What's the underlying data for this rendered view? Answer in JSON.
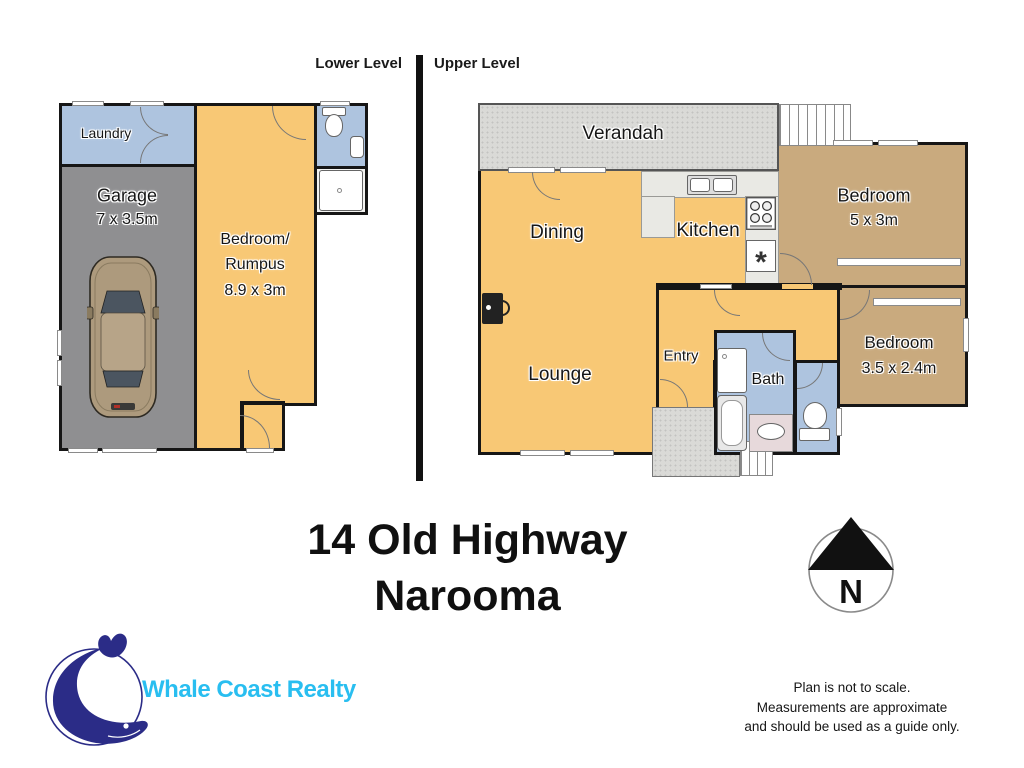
{
  "header": {
    "lower_label": "Lower Level",
    "upper_label": "Upper Level"
  },
  "title": {
    "line1": "14 Old Highway",
    "line2": "Narooma"
  },
  "compass": {
    "letter": "N"
  },
  "logo": {
    "name": "Whale Coast Realty"
  },
  "disclaimer": {
    "line1": "Plan is not to scale.",
    "line2": "Measurements are approximate",
    "line3": "and should be used as a guide only."
  },
  "lower_level": {
    "laundry": {
      "label": "Laundry"
    },
    "garage": {
      "label": "Garage",
      "size": "7 x 3.5m"
    },
    "bedroom_rumpus": {
      "line1": "Bedroom/",
      "line2": "Rumpus",
      "size": "8.9 x 3m"
    }
  },
  "upper_level": {
    "verandah": {
      "label": "Verandah"
    },
    "dining": {
      "label": "Dining"
    },
    "kitchen": {
      "label": "Kitchen",
      "appliance_symbol": "*"
    },
    "bedroom_large": {
      "label": "Bedroom",
      "size": "5 x 3m"
    },
    "lounge": {
      "label": "Lounge"
    },
    "entry": {
      "label": "Entry"
    },
    "bath": {
      "label": "Bath"
    },
    "bedroom_small": {
      "label": "Bedroom",
      "size": "3.5 x 2.4m"
    }
  },
  "colors": {
    "room_orange": "#F8C875",
    "room_blue": "#AEC4DF",
    "room_tan": "#C9AA7E",
    "garage_gray": "#8F8F91",
    "deck_gray": "#DADAD7",
    "wall_black": "#161616",
    "logo_cyan": "#29BEF0",
    "logo_navy": "#2B2C87"
  }
}
